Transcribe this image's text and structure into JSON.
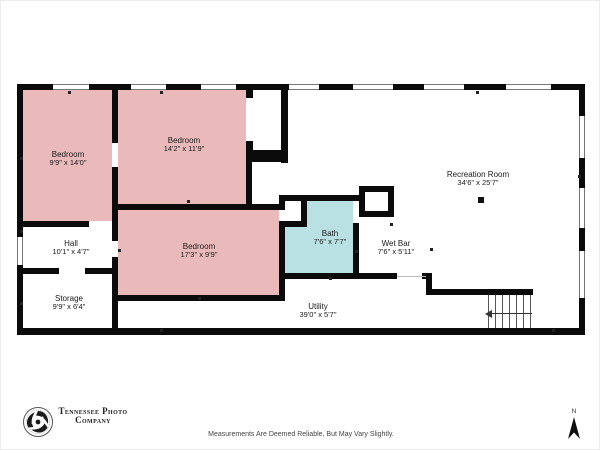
{
  "plan": {
    "rooms": [
      {
        "name": "Bedroom",
        "dims": "9'9\" x 14'0\""
      },
      {
        "name": "Bedroom",
        "dims": "14'2\" x 11'9\""
      },
      {
        "name": "Bedroom",
        "dims": "17'3\" x 9'9\""
      },
      {
        "name": "Hall",
        "dims": "10'1\" x 4'7\""
      },
      {
        "name": "Storage",
        "dims": "9'9\" x 6'4\""
      },
      {
        "name": "Bath",
        "dims": "7'6\" x 7'7\""
      },
      {
        "name": "Wet Bar",
        "dims": "7'6\" x 5'11\""
      },
      {
        "name": "Utility",
        "dims": "39'0\" x 5'7\""
      },
      {
        "name": "Recreation Room",
        "dims": "34'6\" x 25'7\""
      }
    ],
    "colors": {
      "bedroom_fill": "#eab9ba",
      "bath_fill": "#b9e1e3",
      "wall": "#0b0b0b"
    },
    "icons": {
      "compass": "north-arrow",
      "logo_badge": "circular-swirl-camera-badge",
      "stairs_arrow": "left-arrow"
    }
  },
  "footer": {
    "logo_line1": "Tennessee Photo",
    "logo_line2": "Company",
    "disclaimer": "Measurements Are Deemed Reliable, But May Vary Slightly.",
    "compass_label": "N"
  }
}
